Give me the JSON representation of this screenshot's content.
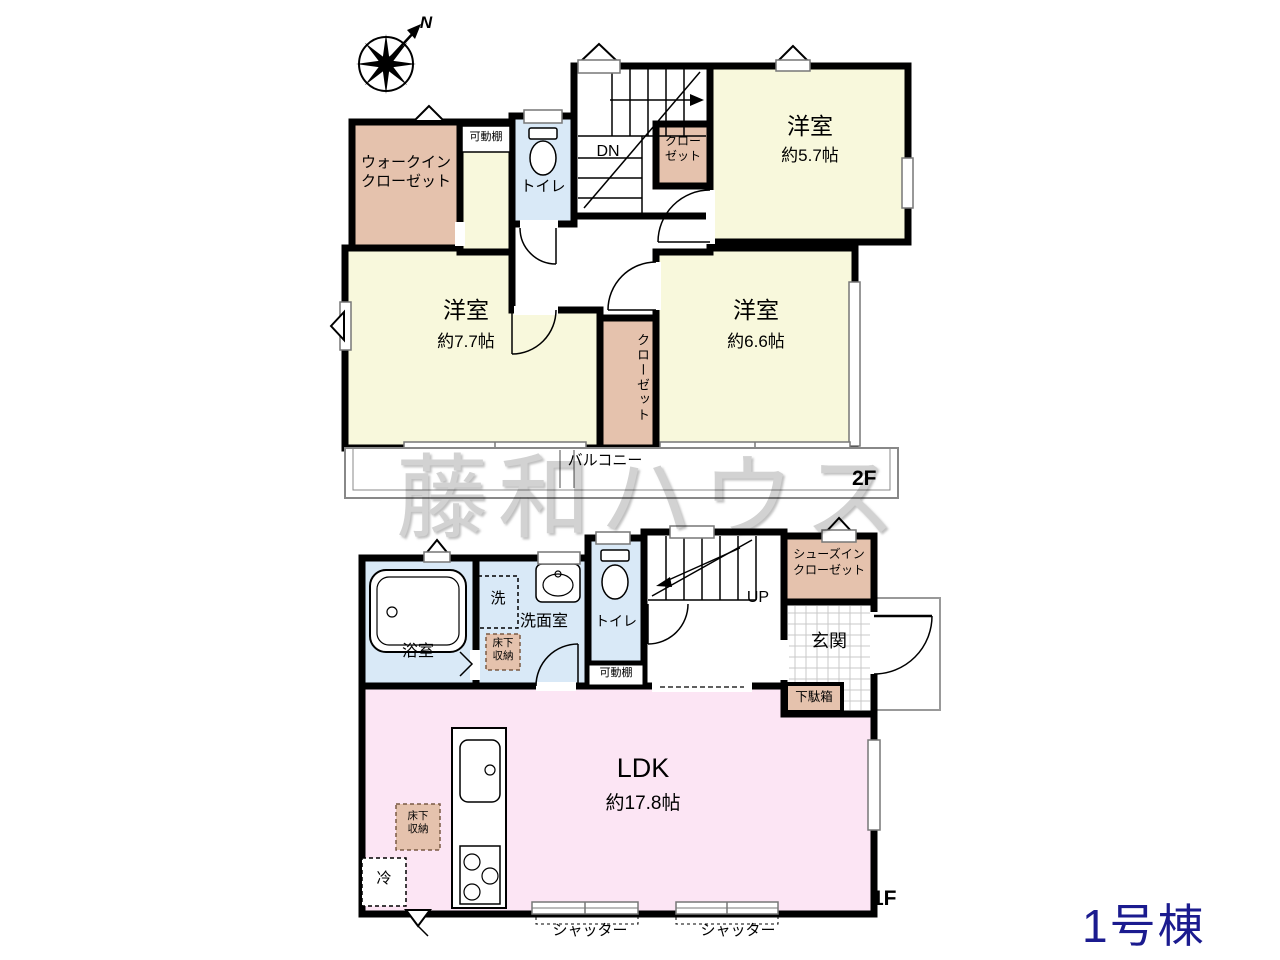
{
  "meta": {
    "building_label": "1号棟",
    "watermark": "藤和ハウス"
  },
  "compass": {
    "north": "N"
  },
  "colors": {
    "wall": "#000000",
    "bedroom_yellow": "#f8f8dc",
    "closet_brown": "#e5c2ad",
    "water_blue": "#d9e9f7",
    "ldk_pink": "#fce5f4",
    "building_label_navy": "#1b1b8f",
    "watermark_gray": "#d2d2d2"
  },
  "floor2": {
    "label": "2F",
    "rooms": {
      "wic": {
        "name": "ウォークイン\nクローゼット"
      },
      "shelf": {
        "name": "可動棚"
      },
      "toilet": {
        "name": "トイレ"
      },
      "stairs": {
        "direction": "DN"
      },
      "closet_57": {
        "name": "クロー\nゼット"
      },
      "bedroom_57": {
        "name": "洋室",
        "size": "約5.7帖"
      },
      "bedroom_77": {
        "name": "洋室",
        "size": "約7.7帖"
      },
      "closet_mid": {
        "name": "クローゼット"
      },
      "bedroom_66": {
        "name": "洋室",
        "size": "約6.6帖"
      },
      "balcony": {
        "name": "バルコニー"
      }
    }
  },
  "floor1": {
    "label": "1F",
    "rooms": {
      "bath": {
        "name": "浴室"
      },
      "washer": {
        "name": "洗"
      },
      "washroom": {
        "name": "洗面室"
      },
      "underfloor_washroom": {
        "name": "床下\n収納"
      },
      "toilet": {
        "name": "トイレ"
      },
      "shelf": {
        "name": "可動棚"
      },
      "stairs": {
        "direction": "UP"
      },
      "shoes_closet": {
        "name": "シューズイン\nクローゼット"
      },
      "entrance": {
        "name": "玄関"
      },
      "shoe_cabinet": {
        "name": "下駄箱"
      },
      "ldk": {
        "name": "LDK",
        "size": "約17.8帖"
      },
      "underfloor_ldk": {
        "name": "床下\n収納"
      },
      "fridge": {
        "name": "冷"
      },
      "shutter_left": {
        "name": "シャッター"
      },
      "shutter_right": {
        "name": "シャッター"
      }
    }
  }
}
